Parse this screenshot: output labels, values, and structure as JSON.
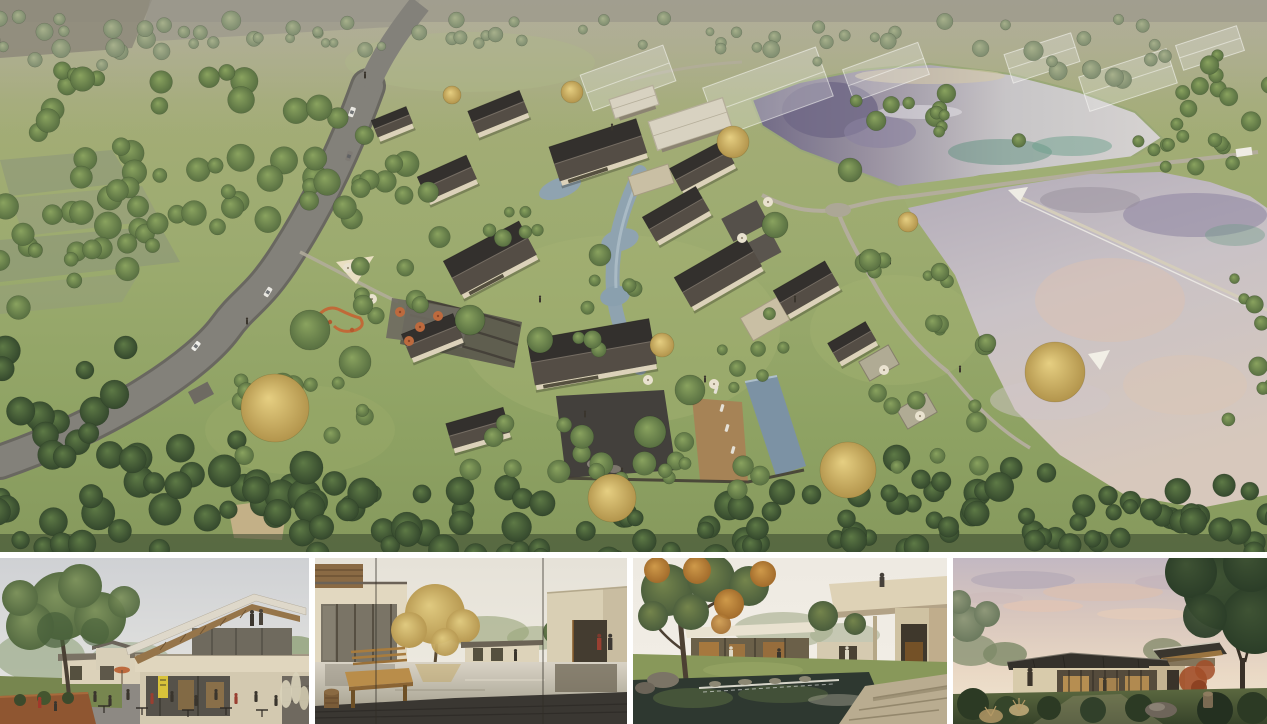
{
  "page": {
    "background": "#ffffff",
    "divider": "#ffffff"
  },
  "colors": {
    "grass_top": "#b2b292",
    "grass_mid": "#9cab6f",
    "grass_low": "#86995d",
    "haze": "#b0ac9a",
    "field_grey": "#8a927c",
    "topband_grey": "#918d80",
    "road": "#83817a",
    "road_edge": "#696760",
    "roof_north": "#33302d",
    "roof_south": "#544d45",
    "roof_ridge": "#756d63",
    "wall_cream": "#dcd2ba",
    "glass_dark": "#55503f",
    "flat_roof": "#d8d2c1",
    "flat_roof_edge": "#b5ae9a",
    "stone_court": "#43403c",
    "deck_wood": "#a68356",
    "stone_wall": "#3f3a33",
    "podium": "#c9bfa4",
    "stream": "#8fa3b0",
    "stream_light": "#bac9d2",
    "pool": "#7c92a4",
    "lake_dark": "#6f6886",
    "lake_silver": "#c9c6ca",
    "lake_pale": "#d8d5d4",
    "lake_pink": "#dcc2b2",
    "lake_teal": "#5f9180",
    "lake_lilac": "#8d84a0",
    "dike_grass": "#9fae74",
    "path_grey": "#b3ad9c",
    "sand": "#d5c9a8",
    "tree_green_hi": "#8aa35f",
    "tree_green_lo": "#51683d",
    "tree_deep_hi": "#5e7a46",
    "tree_deep_lo": "#2e4129",
    "tree_muted_hi": "#a8b18c",
    "tree_muted_lo": "#77866a",
    "tree_gold_hi": "#e6cf82",
    "tree_gold_lo": "#ab8c44",
    "umbrella_orange": "#bd6a3e",
    "umbrella_cream": "#e9e2cf",
    "corten": "#8f5631",
    "sign_yellow": "#d8c23a",
    "car_white": "#e9e7e1",
    "car_grey": "#7e7a74",
    "person_dark": "#3a352d",
    "person_red": "#993f31",
    "sky_t1_top": "#cfd1d4",
    "sky_t1_bot": "#e9e8e3",
    "sky_t2_top": "#e6e2d8",
    "sky_t2_bot": "#efece3",
    "sky_t3_top": "#eeeae2",
    "sky_t3_bot": "#f3efe7",
    "sky_t4_top": "#c3b8c2",
    "sky_t4_mid": "#d8c6bd",
    "sky_t4_bot": "#f0e7d3",
    "maple_red": "#a24e28",
    "pond_dark": "#2e3830",
    "deck_charcoal": "#3a3732",
    "bench_wood": "#b98d4a",
    "stone_slab": "#b9ac90"
  },
  "thumbnails": [
    {
      "id": "street-cafe-view"
    },
    {
      "id": "courtyard-reflecting-pool-view"
    },
    {
      "id": "garden-waterfall-courtyard-view"
    },
    {
      "id": "dusk-pavilion-view"
    }
  ]
}
